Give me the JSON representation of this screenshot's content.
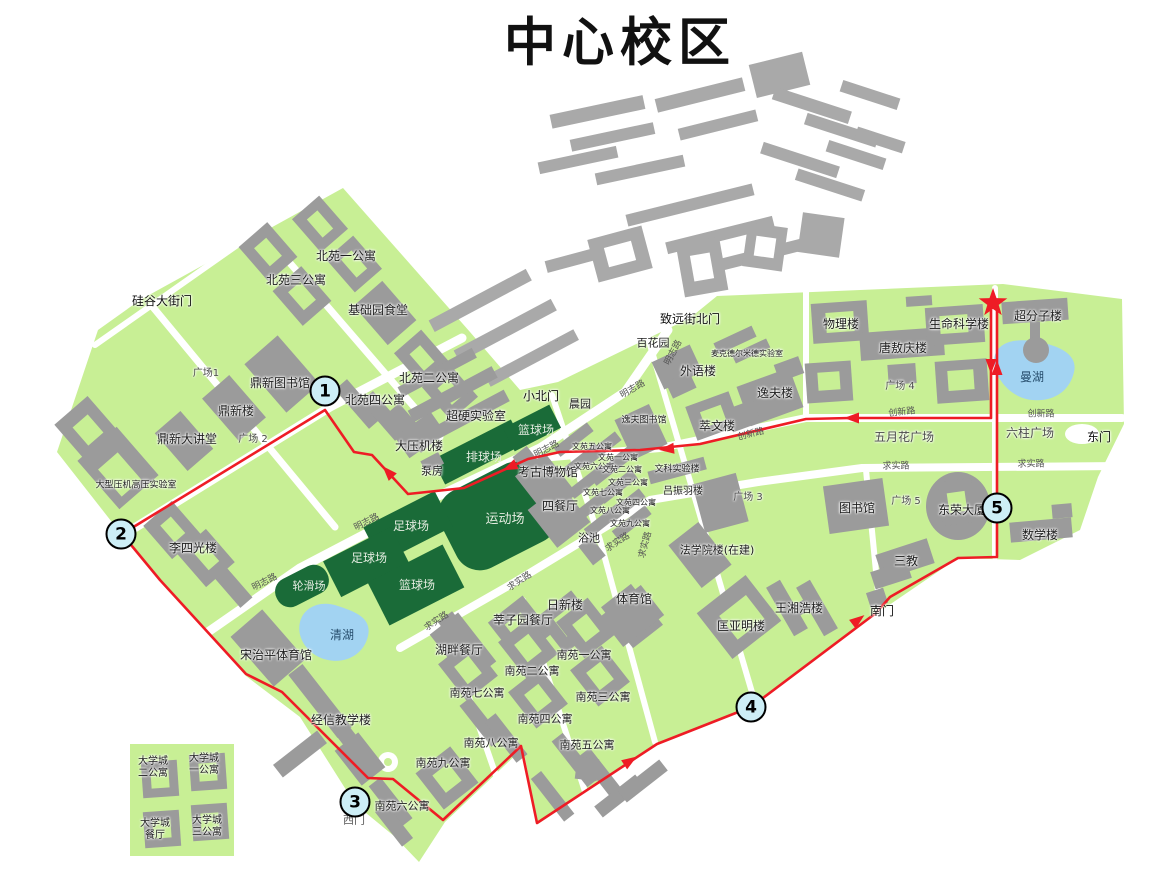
{
  "title": "中心校区",
  "colors": {
    "campus_green": "#c8ef95",
    "building_gray": "#9b9b9b",
    "field_green": "#1a6b38",
    "lake_blue": "#a2d3f2",
    "route_red": "#ee1c25",
    "marker_fill": "#cdeef6"
  },
  "map": {
    "markers": [
      {
        "n": "1",
        "x": 325,
        "y": 391
      },
      {
        "n": "2",
        "x": 121,
        "y": 534
      },
      {
        "n": "3",
        "x": 355,
        "y": 802
      },
      {
        "n": "4",
        "x": 751,
        "y": 707
      },
      {
        "n": "5",
        "x": 997,
        "y": 508
      }
    ],
    "star": {
      "x": 993,
      "y": 303
    },
    "route": {
      "points": [
        [
          991,
          310
        ],
        [
          991,
          418
        ],
        [
          850,
          418
        ],
        [
          806,
          419
        ],
        [
          700,
          444
        ],
        [
          640,
          450
        ],
        [
          560,
          452
        ],
        [
          528,
          459
        ],
        [
          464,
          488
        ],
        [
          408,
          494
        ],
        [
          372,
          455
        ],
        [
          354,
          452
        ],
        [
          325,
          410
        ],
        [
          122,
          534
        ],
        [
          160,
          580
        ],
        [
          246,
          674
        ],
        [
          282,
          692
        ],
        [
          368,
          778
        ],
        [
          393,
          779
        ],
        [
          443,
          820
        ],
        [
          521,
          746
        ],
        [
          537,
          823
        ],
        [
          657,
          744
        ],
        [
          751,
          707
        ],
        [
          876,
          613
        ],
        [
          890,
          597
        ],
        [
          958,
          558
        ],
        [
          997,
          557
        ],
        [
          997,
          310
        ]
      ],
      "arrows": [
        {
          "x": 991,
          "y": 366,
          "a": 90
        },
        {
          "x": 852,
          "y": 418,
          "a": 180
        },
        {
          "x": 667,
          "y": 449,
          "a": 174
        },
        {
          "x": 510,
          "y": 467,
          "a": 156
        },
        {
          "x": 388,
          "y": 472,
          "a": -133
        },
        {
          "x": 630,
          "y": 761,
          "a": -33
        },
        {
          "x": 858,
          "y": 620,
          "a": -37
        },
        {
          "x": 997,
          "y": 368,
          "a": -90
        }
      ]
    },
    "labels": [
      {
        "t": "硅谷大街门",
        "x": 162,
        "y": 301,
        "c": "c-gate"
      },
      {
        "t": "致远街北门",
        "x": 690,
        "y": 319,
        "c": "c-gate"
      },
      {
        "t": "小北门",
        "x": 541,
        "y": 396,
        "c": "c-gate"
      },
      {
        "t": "东门",
        "x": 1099,
        "y": 437,
        "c": "c-gate"
      },
      {
        "t": "南门",
        "x": 882,
        "y": 611,
        "c": "c-gate"
      },
      {
        "t": "西门",
        "x": 354,
        "y": 820,
        "s": 11,
        "c": "c-road"
      },
      {
        "t": "北苑一公寓",
        "x": 346,
        "y": 256
      },
      {
        "t": "北苑三公寓",
        "x": 296,
        "y": 280
      },
      {
        "t": "基础园食堂",
        "x": 378,
        "y": 310
      },
      {
        "t": "北苑二公寓",
        "x": 429,
        "y": 378
      },
      {
        "t": "北苑四公寓",
        "x": 375,
        "y": 400
      },
      {
        "t": "鼎新图书馆",
        "x": 280,
        "y": 383
      },
      {
        "t": "鼎新楼",
        "x": 236,
        "y": 411
      },
      {
        "t": "鼎新大讲堂",
        "x": 187,
        "y": 439
      },
      {
        "t": "大型压机高压实验室",
        "x": 136,
        "y": 486,
        "s": 9
      },
      {
        "t": "李四光楼",
        "x": 193,
        "y": 548
      },
      {
        "t": "大压机楼",
        "x": 419,
        "y": 446
      },
      {
        "t": "超硬实验室",
        "x": 476,
        "y": 416
      },
      {
        "t": "泵房",
        "x": 432,
        "y": 471,
        "s": 11
      },
      {
        "t": "宋治平体育馆",
        "x": 276,
        "y": 655
      },
      {
        "t": "经信教学楼",
        "x": 341,
        "y": 720
      },
      {
        "t": "湖畔餐厅",
        "x": 459,
        "y": 650
      },
      {
        "t": "莘子园餐厅",
        "x": 523,
        "y": 620
      },
      {
        "t": "日新楼",
        "x": 565,
        "y": 605
      },
      {
        "t": "体育馆",
        "x": 634,
        "y": 599
      },
      {
        "t": "考古博物馆",
        "x": 548,
        "y": 472
      },
      {
        "t": "四餐厅",
        "x": 560,
        "y": 506
      },
      {
        "t": "浴池",
        "x": 589,
        "y": 538,
        "s": 11
      },
      {
        "t": "晨园",
        "x": 580,
        "y": 404,
        "s": 11
      },
      {
        "t": "百花园",
        "x": 653,
        "y": 343,
        "s": 11
      },
      {
        "t": "外语楼",
        "x": 698,
        "y": 371
      },
      {
        "t": "麦克德尔米德实验室",
        "x": 747,
        "y": 354,
        "s": 8
      },
      {
        "t": "逸夫楼",
        "x": 775,
        "y": 393
      },
      {
        "t": "萃文楼",
        "x": 717,
        "y": 426
      },
      {
        "t": "逸夫图书馆",
        "x": 644,
        "y": 421,
        "s": 9
      },
      {
        "t": "文科实验楼",
        "x": 677,
        "y": 470,
        "s": 9
      },
      {
        "t": "吕振羽楼",
        "x": 683,
        "y": 492,
        "s": 10
      },
      {
        "t": "法学院楼(在建)",
        "x": 717,
        "y": 550,
        "s": 11
      },
      {
        "t": "匡亚明楼",
        "x": 741,
        "y": 626
      },
      {
        "t": "王湘浩楼",
        "x": 799,
        "y": 608
      },
      {
        "t": "图书馆",
        "x": 857,
        "y": 508
      },
      {
        "t": "东荣大厦",
        "x": 962,
        "y": 510
      },
      {
        "t": "数学楼",
        "x": 1040,
        "y": 535
      },
      {
        "t": "三教",
        "x": 906,
        "y": 561
      },
      {
        "t": "物理楼",
        "x": 841,
        "y": 324
      },
      {
        "t": "唐敖庆楼",
        "x": 903,
        "y": 348
      },
      {
        "t": "生命科学楼",
        "x": 959,
        "y": 324
      },
      {
        "t": "超分子楼",
        "x": 1038,
        "y": 316
      },
      {
        "t": "南苑一公寓",
        "x": 584,
        "y": 655,
        "s": 11
      },
      {
        "t": "南苑二公寓",
        "x": 532,
        "y": 671,
        "s": 11
      },
      {
        "t": "南苑三公寓",
        "x": 603,
        "y": 697,
        "s": 11
      },
      {
        "t": "南苑四公寓",
        "x": 545,
        "y": 719,
        "s": 11
      },
      {
        "t": "南苑五公寓",
        "x": 587,
        "y": 745,
        "s": 11
      },
      {
        "t": "南苑六公寓",
        "x": 402,
        "y": 806,
        "s": 11
      },
      {
        "t": "南苑七公寓",
        "x": 477,
        "y": 693,
        "s": 11
      },
      {
        "t": "南苑八公寓",
        "x": 491,
        "y": 743,
        "s": 11
      },
      {
        "t": "南苑九公寓",
        "x": 443,
        "y": 763,
        "s": 11
      },
      {
        "t": "文苑五公寓",
        "x": 592,
        "y": 447,
        "s": 8
      },
      {
        "t": "文苑一公寓",
        "x": 618,
        "y": 458,
        "s": 8
      },
      {
        "t": "文苑六公寓",
        "x": 594,
        "y": 467,
        "s": 8
      },
      {
        "t": "文苑二公寓",
        "x": 622,
        "y": 470,
        "s": 8
      },
      {
        "t": "文苑三公寓",
        "x": 628,
        "y": 483,
        "s": 8
      },
      {
        "t": "文苑七公寓",
        "x": 603,
        "y": 493,
        "s": 8
      },
      {
        "t": "文苑四公寓",
        "x": 636,
        "y": 503,
        "s": 8
      },
      {
        "t": "文苑八公寓",
        "x": 610,
        "y": 511,
        "s": 8
      },
      {
        "t": "文苑九公寓",
        "x": 630,
        "y": 524,
        "s": 8
      },
      {
        "t": "大学城\n二公寓",
        "x": 153,
        "y": 768,
        "s": 10
      },
      {
        "t": "大学城\n一公寓",
        "x": 204,
        "y": 765,
        "s": 10
      },
      {
        "t": "大学城\n餐厅",
        "x": 155,
        "y": 830,
        "s": 10
      },
      {
        "t": "大学城\n三公寓",
        "x": 207,
        "y": 827,
        "s": 10
      },
      {
        "t": "广场1",
        "x": 206,
        "y": 374,
        "s": 10,
        "c": "c-plaza"
      },
      {
        "t": "广场 2",
        "x": 253,
        "y": 440,
        "s": 10,
        "c": "c-plaza"
      },
      {
        "t": "广场 3",
        "x": 748,
        "y": 498,
        "s": 10,
        "c": "c-plaza"
      },
      {
        "t": "广场 4",
        "x": 900,
        "y": 387,
        "s": 10,
        "c": "c-plaza"
      },
      {
        "t": "广场 5",
        "x": 906,
        "y": 502,
        "s": 10,
        "c": "c-plaza"
      },
      {
        "t": "五月花广场",
        "x": 904,
        "y": 437,
        "c": "c-plaza"
      },
      {
        "t": "六柱广场",
        "x": 1030,
        "y": 433,
        "c": "c-plaza"
      },
      {
        "t": "清湖",
        "x": 342,
        "y": 635,
        "c": "c-water"
      },
      {
        "t": "曼湖",
        "x": 1032,
        "y": 377,
        "c": "c-water"
      },
      {
        "t": "排球场",
        "x": 484,
        "y": 457,
        "c": "c-field"
      },
      {
        "t": "篮球场",
        "x": 536,
        "y": 430,
        "c": "c-field"
      },
      {
        "t": "运动场",
        "x": 505,
        "y": 520,
        "s": 13,
        "c": "c-field"
      },
      {
        "t": "足球场",
        "x": 411,
        "y": 526,
        "c": "c-field"
      },
      {
        "t": "足球场",
        "x": 369,
        "y": 558,
        "c": "c-field"
      },
      {
        "t": "篮球场",
        "x": 417,
        "y": 585,
        "c": "c-field"
      },
      {
        "t": "轮滑场",
        "x": 309,
        "y": 586,
        "s": 11,
        "c": "c-field"
      },
      {
        "t": "明志路",
        "x": 674,
        "y": 353,
        "s": 9,
        "r": -62,
        "c": "c-road"
      },
      {
        "t": "明志路",
        "x": 633,
        "y": 390,
        "s": 9,
        "r": -30,
        "c": "c-road"
      },
      {
        "t": "明志路",
        "x": 547,
        "y": 450,
        "s": 9,
        "r": -27,
        "c": "c-road"
      },
      {
        "t": "明志路",
        "x": 367,
        "y": 523,
        "s": 9,
        "r": -27,
        "c": "c-road"
      },
      {
        "t": "明志路",
        "x": 265,
        "y": 583,
        "s": 9,
        "r": -27,
        "c": "c-road"
      },
      {
        "t": "求实路",
        "x": 618,
        "y": 543,
        "s": 9,
        "r": -33,
        "c": "c-road"
      },
      {
        "t": "求实路",
        "x": 520,
        "y": 582,
        "s": 9,
        "r": -33,
        "c": "c-road"
      },
      {
        "t": "求实路",
        "x": 437,
        "y": 622,
        "s": 9,
        "r": -33,
        "c": "c-road"
      },
      {
        "t": "求实路",
        "x": 646,
        "y": 545,
        "s": 9,
        "r": -75,
        "c": "c-road"
      },
      {
        "t": "求实路",
        "x": 896,
        "y": 467,
        "s": 9,
        "c": "c-road"
      },
      {
        "t": "求实路",
        "x": 1031,
        "y": 465,
        "s": 9,
        "c": "c-road"
      },
      {
        "t": "创新路",
        "x": 902,
        "y": 413,
        "s": 9,
        "r": -6,
        "c": "c-road"
      },
      {
        "t": "创新路",
        "x": 751,
        "y": 435,
        "s": 9,
        "r": -14,
        "c": "c-road"
      },
      {
        "t": "创新路",
        "x": 1041,
        "y": 415,
        "s": 9,
        "c": "c-road"
      }
    ]
  }
}
